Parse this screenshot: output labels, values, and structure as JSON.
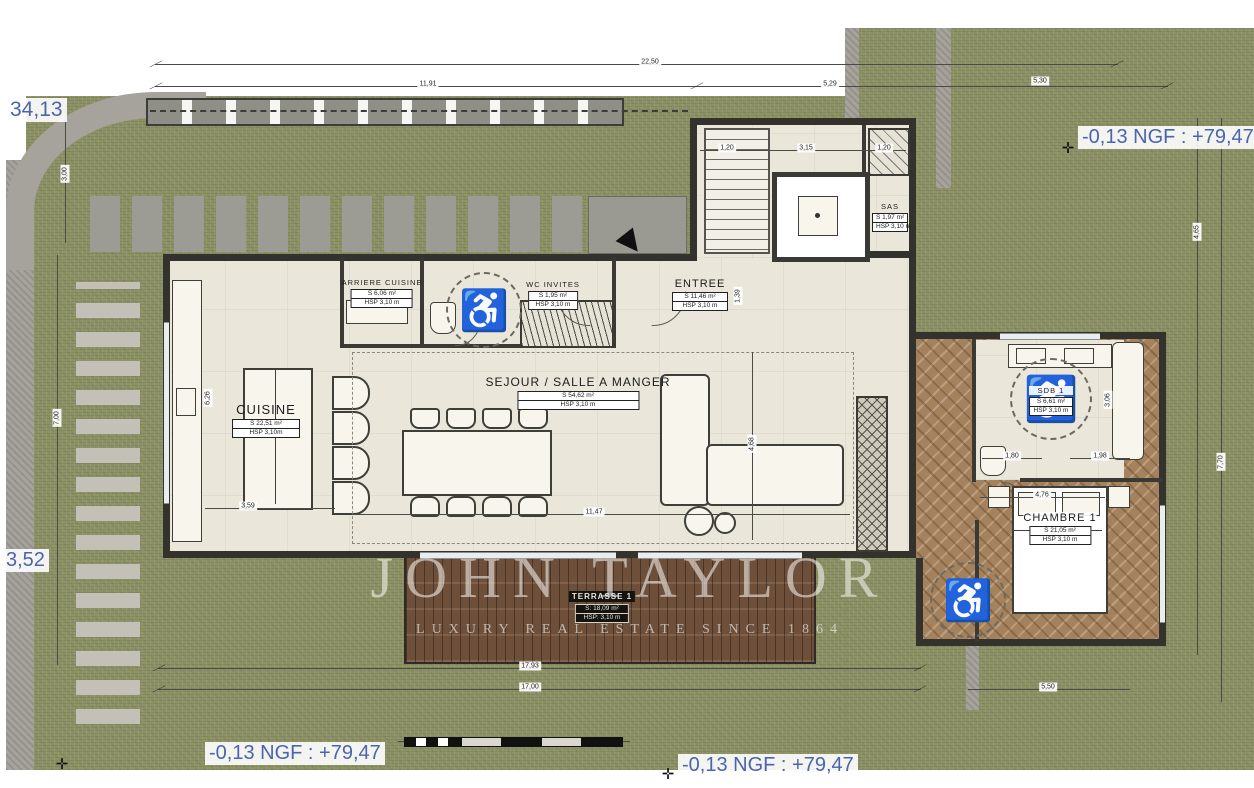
{
  "plan": {
    "title": "Villa ground floor plan",
    "watermark": {
      "line1": "JOHN TAYLOR",
      "line2": "LUXURY REAL ESTATE SINCE 1864"
    },
    "annotations": {
      "elev_top_left": "34,13",
      "elev_left": "3,52",
      "ngf_top_right": "-0,13 NGF : +79,47",
      "ngf_bottom_left": "-0,13 NGF : +79,47",
      "ngf_bottom_right": "-0,13 NGF : +79,47"
    },
    "rooms": [
      {
        "id": "cuisine",
        "name": "CUISINE",
        "area": "S 22,51 m²",
        "hsp": "HSP 3,10m"
      },
      {
        "id": "arriere-cuisine",
        "name": "ARRIERE CUISINE",
        "area": "S 6,06 m²",
        "hsp": "HSP 3,10 m"
      },
      {
        "id": "wc-invites",
        "name": "WC INVITES",
        "area": "S 1,95 m²",
        "hsp": "HSP 3,10 m"
      },
      {
        "id": "entree",
        "name": "ENTREE",
        "area": "S 11,46 m²",
        "hsp": "HSP 3,10 m"
      },
      {
        "id": "sejour",
        "name": "SEJOUR / SALLE A MANGER",
        "area": "S 54,62 m²",
        "hsp": "HSP 3,10 m"
      },
      {
        "id": "sas",
        "name": "SAS",
        "area": "S 1,97 m²",
        "hsp": "HSP 3,10 m"
      },
      {
        "id": "sdb-1",
        "name": "SDB 1",
        "area": "S 6,61 m²",
        "hsp": "HSP 3,10 m"
      },
      {
        "id": "chambre-1",
        "name": "CHAMBRE 1",
        "area": "S 21,05 m²",
        "hsp": "HSP 3,10 m"
      },
      {
        "id": "terrasse-1",
        "name": "TERRASSE 1",
        "area": "S: 18,09 m²",
        "hsp": "HSP: 3,10 m"
      }
    ],
    "dims": {
      "top_22_50": "22,50",
      "top_11_91": "11,91",
      "top_5_29": "5,29",
      "top_5_30": "5,30",
      "bottom_17_93": "17,93",
      "bottom_17_00": "17,00",
      "bottom_5_50": "5,50",
      "left_3_00": "3,00",
      "left_7_00": "7,00",
      "left_6_26": "6,26",
      "right_4_65": "4,65",
      "right_7_70": "7,70",
      "int_3_59": "3,59",
      "int_11_47": "11,47",
      "int_4_68": "4,68",
      "int_4_76": "4,76",
      "int_1_80": "1,80",
      "int_1_98": "1,98",
      "int_3_06": "3,06",
      "int_1_20a": "1,20",
      "int_3_15": "3,15",
      "int_1_20b": "1,20",
      "int_1_39": "1,39"
    },
    "icons": {
      "wheelchair": "♿"
    },
    "colors": {
      "annotation_blue": "#4a64ae",
      "grass_green": "#8d9366",
      "terrace_wood": "#6e4f3a",
      "herringbone_wood": "#a4825d",
      "wall": "#33322d",
      "floor": "#eae6da"
    }
  }
}
